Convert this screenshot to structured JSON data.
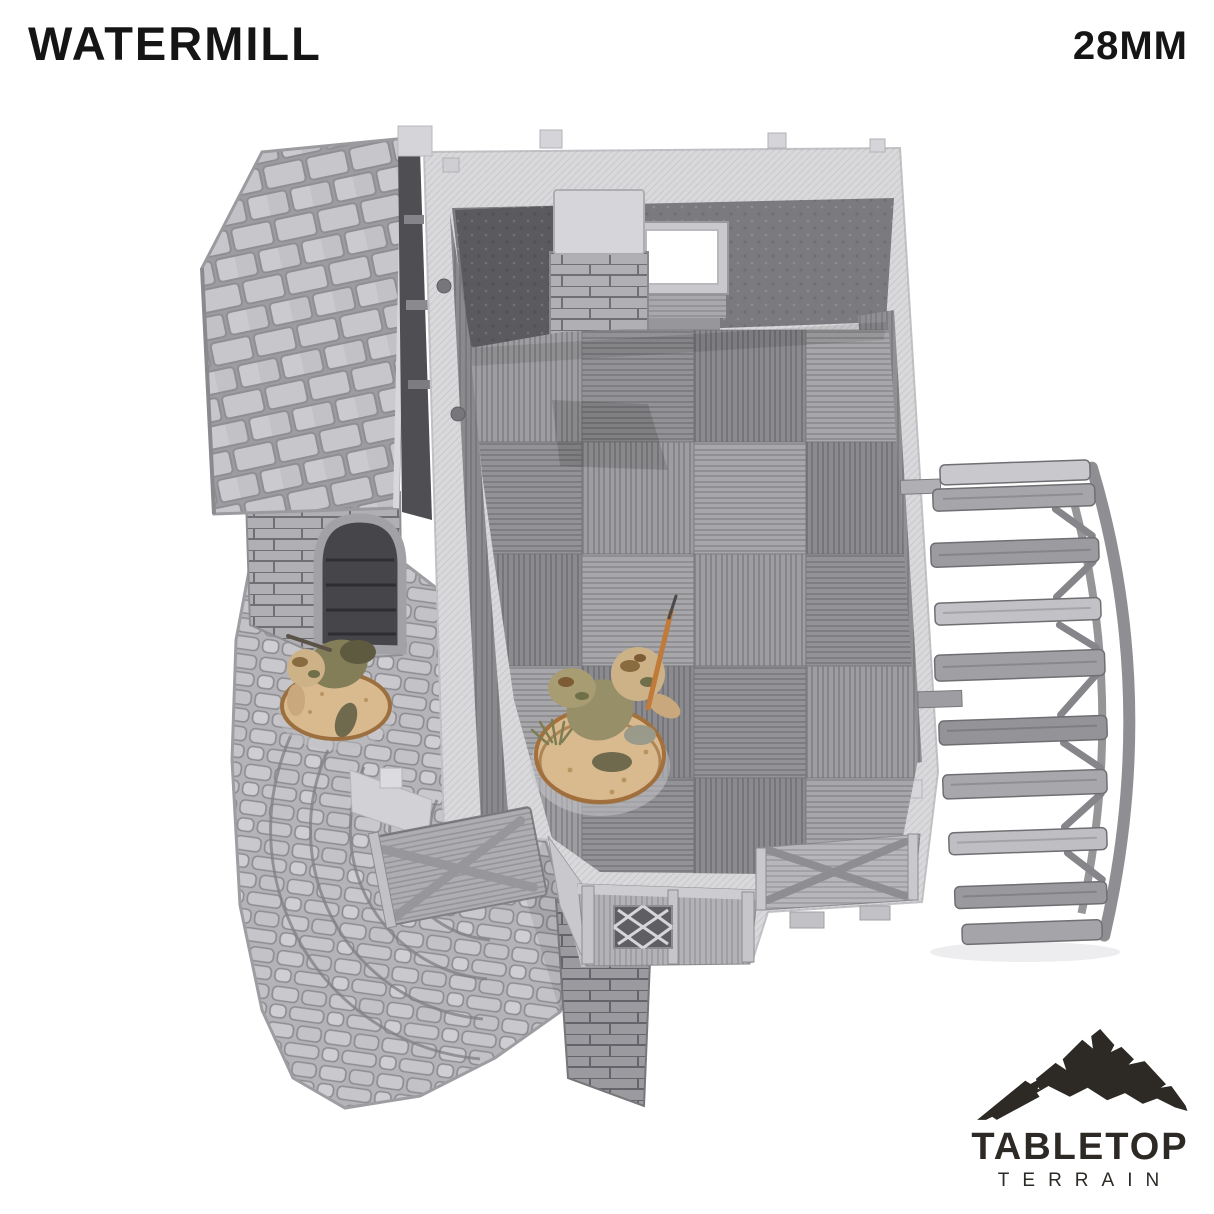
{
  "header": {
    "title": "WATERMILL",
    "scale": "28MM"
  },
  "brand": {
    "name": "TABLETOP",
    "subtitle": "TERRAIN",
    "logo_color": "#2d2925"
  },
  "photo": {
    "subject": "Grey 3D printed watermill terrain piece seen from above: open plank-floor interior, stone chimney, shingled side roof with arched doorway, curved stone stair path, wooden water wheel, and two 28mm camouflaged soldier miniatures",
    "parts": [
      "shingle-roof",
      "arched-doorway",
      "stone-chimney",
      "window-opening",
      "plank-floor",
      "water-wheel",
      "stone-stair-path",
      "wooden-door",
      "lattice-window",
      "braced-wall-panel",
      "kneeling-soldier-miniature",
      "running-soldier-miniature"
    ]
  },
  "palette": {
    "background": "#ffffff",
    "text": "#151515",
    "logo": "#2d2925",
    "model_light": "#d9d9db",
    "model_mid": "#a9a9ad",
    "model_dark": "#6e6e72",
    "mini_olive": "#8a8463",
    "mini_tan": "#cdb287",
    "base_sand": "#d8ba8e"
  }
}
